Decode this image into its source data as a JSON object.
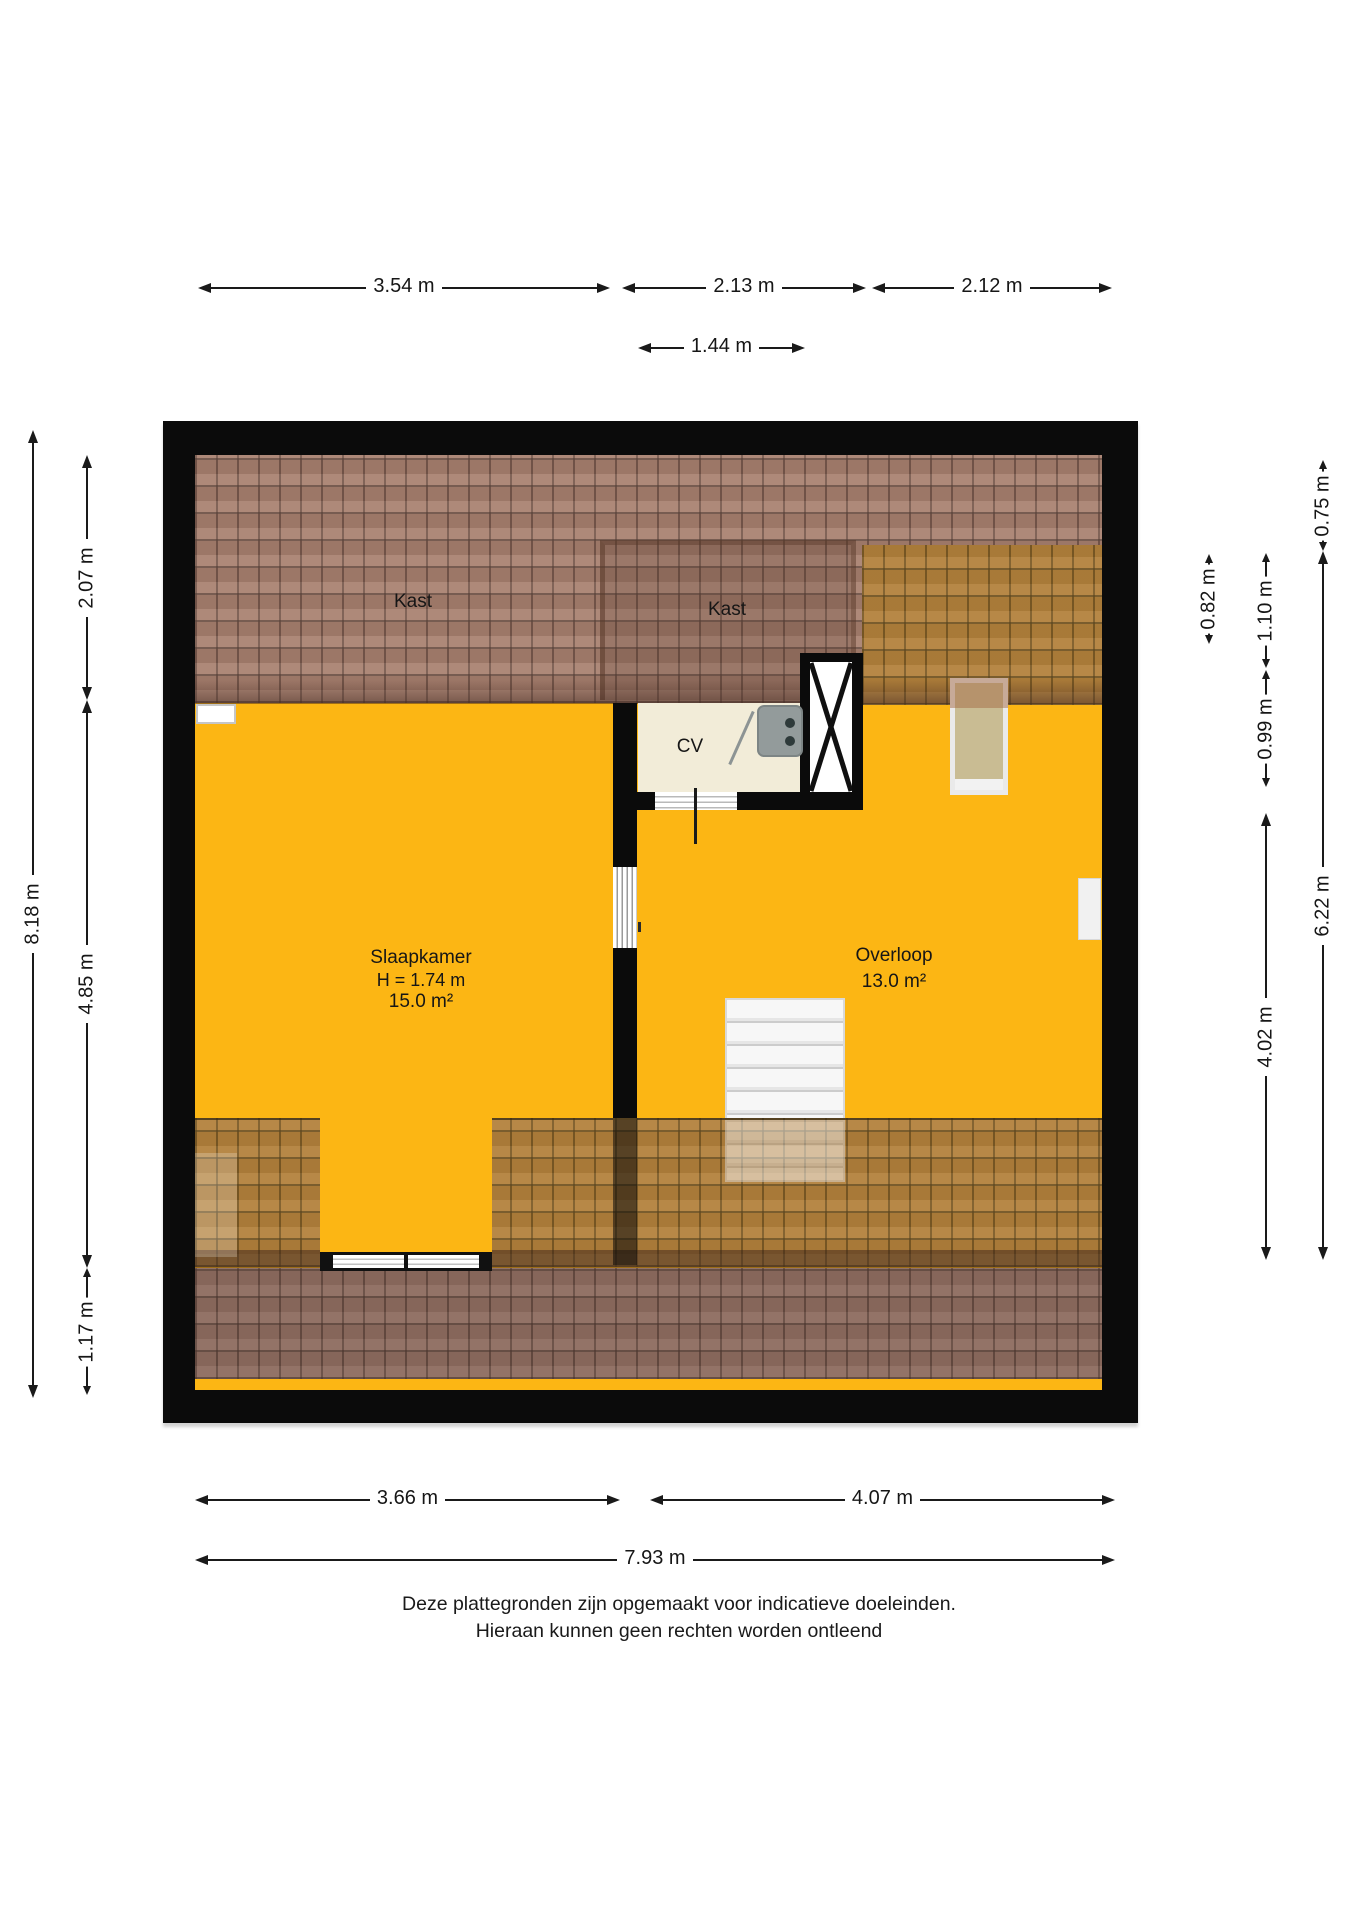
{
  "floorplan": {
    "type": "attic floor plan",
    "rooms": {
      "kast1": {
        "label": "Kast"
      },
      "kast2": {
        "label": "Kast"
      },
      "cv": {
        "label": "CV"
      },
      "slaapkamer": {
        "label": "Slaapkamer",
        "height_line": "H = 1.74 m",
        "area_line": "15.0 m²"
      },
      "overloop": {
        "label": "Overloop",
        "area_line": "13.0 m²"
      }
    },
    "colors": {
      "floor_yellow": "#fcb614",
      "roof_tile_pink": "#a8806f",
      "roof_tile_orange": "#b3813c",
      "roof_tile_muted": "#8d6c5f",
      "wall_black": "#0b0b0b",
      "cv_room_cream": "#f2ecd8"
    }
  },
  "dimensions": {
    "top_a": {
      "text": "3.54 m"
    },
    "top_b": {
      "text": "2.13 m"
    },
    "top_c": {
      "text": "2.12 m"
    },
    "top_d": {
      "text": "1.44 m"
    },
    "left_total": {
      "text": "8.18 m"
    },
    "left_a": {
      "text": "2.07 m"
    },
    "left_b": {
      "text": "4.85 m"
    },
    "left_c": {
      "text": "1.17 m"
    },
    "right_a": {
      "text": "0.82 m"
    },
    "right_b": {
      "text": "1.10 m"
    },
    "right_c": {
      "text": "0.99 m"
    },
    "right_d": {
      "text": "4.02 m"
    },
    "right_e": {
      "text": "0.75 m"
    },
    "right_total": {
      "text": "6.22 m"
    },
    "bottom_a": {
      "text": "3.66 m"
    },
    "bottom_b": {
      "text": "4.07 m"
    },
    "bottom_total": {
      "text": "7.93 m"
    }
  },
  "disclaimer": {
    "line1": "Deze plattegronden zijn opgemaakt voor indicatieve doeleinden.",
    "line2": "Hieraan kunnen geen rechten worden ontleend"
  }
}
